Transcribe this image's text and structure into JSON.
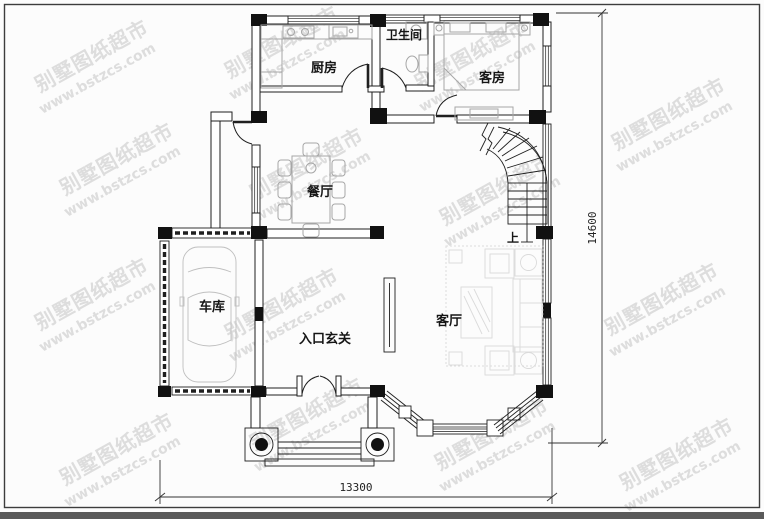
{
  "watermark": {
    "brand": "别墅图纸超市",
    "url": "www.bstzcs.com"
  },
  "rooms": {
    "kitchen": "厨房",
    "bathroom": "卫生间",
    "guest_room": "客房",
    "dining_room": "餐厅",
    "garage": "车库",
    "entrance_foyer": "入口玄关",
    "living_room": "客厅",
    "stair_up": "上"
  },
  "dimensions": {
    "width_mm": "13300",
    "height_mm": "14600"
  },
  "colors": {
    "line": "#1f1f1f",
    "furniture_gray": "#a6a6a6",
    "watermark_gray": "#c3c3c3",
    "background": "#fcfcfc",
    "footer_bar": "#5a5a5a",
    "column_fill": "#111111"
  }
}
